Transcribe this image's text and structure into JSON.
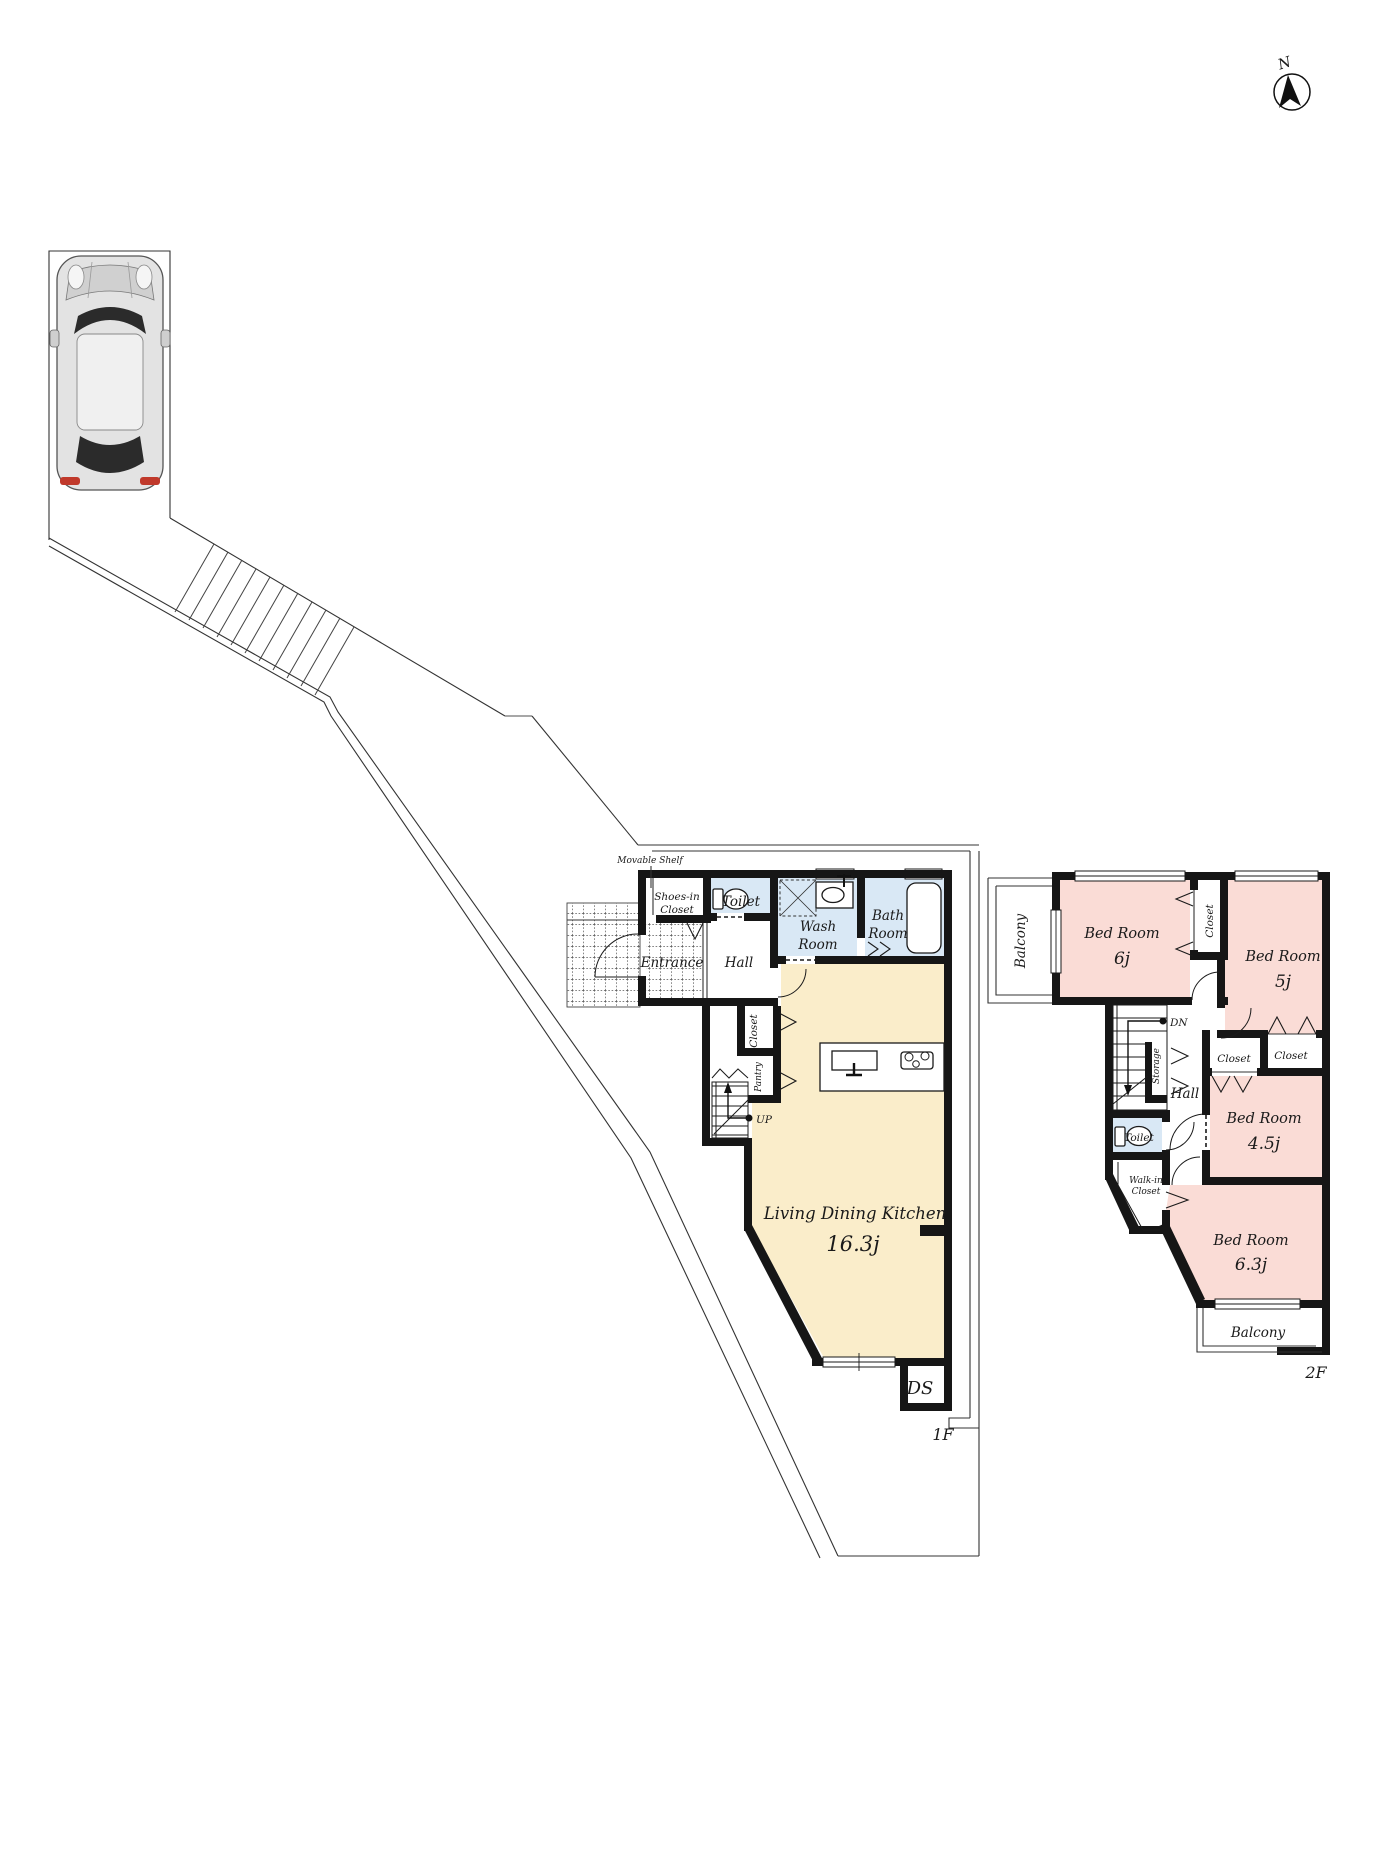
{
  "compass": {
    "north_label": "N"
  },
  "colors": {
    "wall": "#161616",
    "room_blue": "#d9e8f5",
    "room_cream": "#faedca",
    "room_pink": "#fadcd6",
    "line": "#333333"
  },
  "floor1": {
    "floor_label": "1F",
    "movable_shelf_label": "Movable Shelf",
    "shoes_in_closet_line1": "Shoes-in",
    "shoes_in_closet_line2": "Closet",
    "toilet": "Toilet",
    "wash_room_line1": "Wash",
    "wash_room_line2": "Room",
    "bath_room_line1": "Bath",
    "bath_room_line2": "Room",
    "entrance": "Entrance",
    "hall": "Hall",
    "closet": "Closet",
    "pantry": "Pantry",
    "up": "UP",
    "ldk_name": "Living Dining Kitchen",
    "ldk_size": "16.3j",
    "ds": "DS"
  },
  "floor2": {
    "floor_label": "2F",
    "balcony_top": "Balcony",
    "bedroom_6_name": "Bed Room",
    "bedroom_6_size": "6j",
    "closet_top": "Closet",
    "bedroom_5_name": "Bed Room",
    "bedroom_5_size": "5j",
    "dn": "DN",
    "storage": "Storage",
    "hall": "Hall",
    "closet_left": "Closet",
    "closet_right": "Closet",
    "bedroom_45_name": "Bed Room",
    "bedroom_45_size": "4.5j",
    "toilet": "Toilet",
    "walk_in_closet_line1": "Walk-in",
    "walk_in_closet_line2": "Closet",
    "bedroom_63_name": "Bed Room",
    "bedroom_63_size": "6.3j",
    "balcony_bottom": "Balcony"
  }
}
